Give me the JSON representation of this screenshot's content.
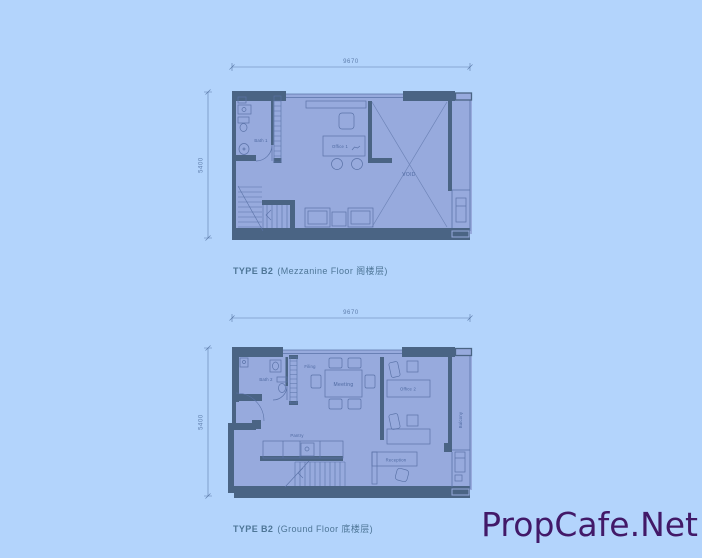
{
  "watermark": {
    "text": "PropCafe.Net",
    "color": "#421968"
  },
  "mezzanine": {
    "title_type": "TYPE B2",
    "title_floor": "(Mezzanine Floor 阁楼层)",
    "dim_top": "9670",
    "dim_left": "5400",
    "labels": {
      "bath": "Bath 1",
      "office": "Office 1",
      "void": "VOID"
    }
  },
  "ground": {
    "title_type": "TYPE B2",
    "title_floor": "(Ground Floor 底楼层)",
    "dim_top": "9670",
    "dim_left": "5400",
    "labels": {
      "bath": "Bath 2",
      "filing": "Filing",
      "meeting": "Meeting",
      "office": "Office 2",
      "balcony": "Balcony",
      "pantry": "Pantry",
      "reception": "Reception"
    }
  },
  "colors": {
    "background": "#b3d4fc",
    "plan_fill": "#97aadd",
    "wall": "#4a6484",
    "line": "#5b73a8",
    "label": "#4d68a0",
    "dimension": "#5e7dab",
    "title": "#4e7697",
    "watermark": "#421968"
  }
}
